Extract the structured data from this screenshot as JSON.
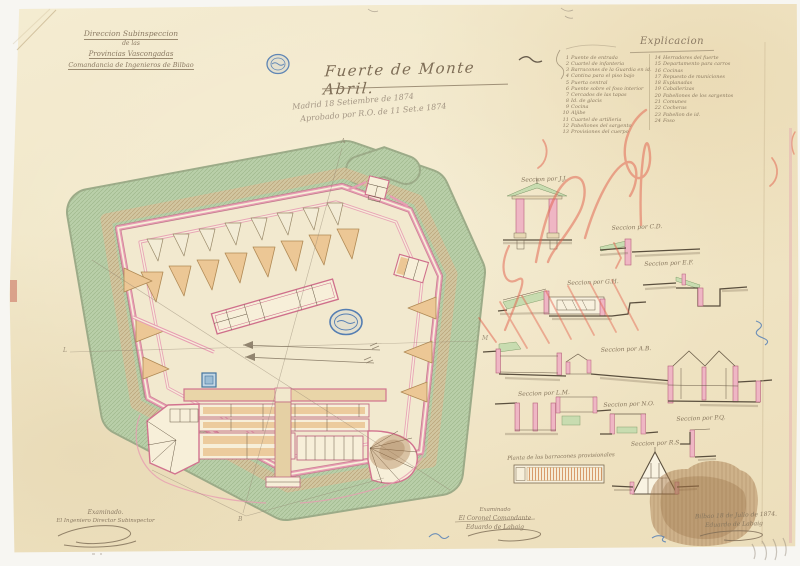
{
  "colors": {
    "paper": "#f2e7c9",
    "glacis_green": "#b7cda6",
    "wall_pink": "#e79cb2",
    "ink": "#8b7a63",
    "stamp_blue": "#3a6cae",
    "crayon_red": "#e2604c",
    "stain_brown": "#a87a4c"
  },
  "header": {
    "line1": "Direccion Subinspeccion",
    "line2": "de las",
    "line3": "Provincias Vascongadas",
    "line4": "Comandancia de Ingenieros de Bilbao"
  },
  "title": {
    "text": "Fuerte de Monte Abril."
  },
  "pencil": {
    "line1": "Madrid 18 Setiembre de 1874",
    "line2": "Aprobado por R.O. de 11 Set.e 1874"
  },
  "legend": {
    "title": "Explicacion",
    "left": [
      {
        "n": "1",
        "t": "Puente de entrada"
      },
      {
        "n": "2",
        "t": "Cuartel de infanteria"
      },
      {
        "n": "3",
        "t": "Barracones de la Guardia en id."
      },
      {
        "n": "4",
        "t": "Cantina para el piso bajo"
      },
      {
        "n": "5",
        "t": "Puerta central"
      },
      {
        "n": "6",
        "t": "Puente sobre el foso interior"
      },
      {
        "n": "7",
        "t": "Cercados de las tapas"
      },
      {
        "n": "8",
        "t": "Id. de glacis"
      },
      {
        "n": "9",
        "t": "Cocina"
      },
      {
        "n": "10",
        "t": "Aljibe"
      },
      {
        "n": "11",
        "t": "Cuartel de artilleria"
      },
      {
        "n": "12",
        "t": "Pabellones del sargento"
      },
      {
        "n": "13",
        "t": "Provisiones del cuerpo"
      }
    ],
    "right": [
      {
        "n": "14",
        "t": "Herradores del fuerte"
      },
      {
        "n": "15",
        "t": "Departamento para carros"
      },
      {
        "n": "16",
        "t": "Cocinas"
      },
      {
        "n": "17",
        "t": "Repuesto de municiones"
      },
      {
        "n": "18",
        "t": "Explanadas"
      },
      {
        "n": "19",
        "t": "Caballerizas"
      },
      {
        "n": "20",
        "t": "Pabellones de los sargentos"
      },
      {
        "n": "21",
        "t": "Comunes"
      },
      {
        "n": "22",
        "t": "Cocheras"
      },
      {
        "n": "23",
        "t": "Pabellon de id."
      },
      {
        "n": "24",
        "t": "Foso"
      }
    ]
  },
  "sections": {
    "jj": "Seccion por J.J.",
    "cd": "Seccion por C.D.",
    "ef": "Seccion por E.F.",
    "gh": "Seccion por G.H.",
    "ab": "Seccion por A.B.",
    "lm": "Seccion por L.M.",
    "no": "Seccion por N.O.",
    "pq": "Seccion por P.Q.",
    "rs": "Seccion por R.S.",
    "barracks": "Planta de los barracones provisionales"
  },
  "signatures": {
    "left": {
      "line1": "Examinado.",
      "line2": "El Ingeniero Director Subinspector"
    },
    "center": {
      "line1": "Examinado",
      "line2": "El Coronel Comandante",
      "line3": "Eduardo de Labaig"
    },
    "right": {
      "date": "Bilbao 18 de Julio de 1874.",
      "name": "Eduardo de Labaig"
    }
  },
  "plan": {
    "cut_letters": [
      {
        "t": "A"
      },
      {
        "t": "B"
      },
      {
        "t": "L"
      },
      {
        "t": "M"
      }
    ]
  }
}
